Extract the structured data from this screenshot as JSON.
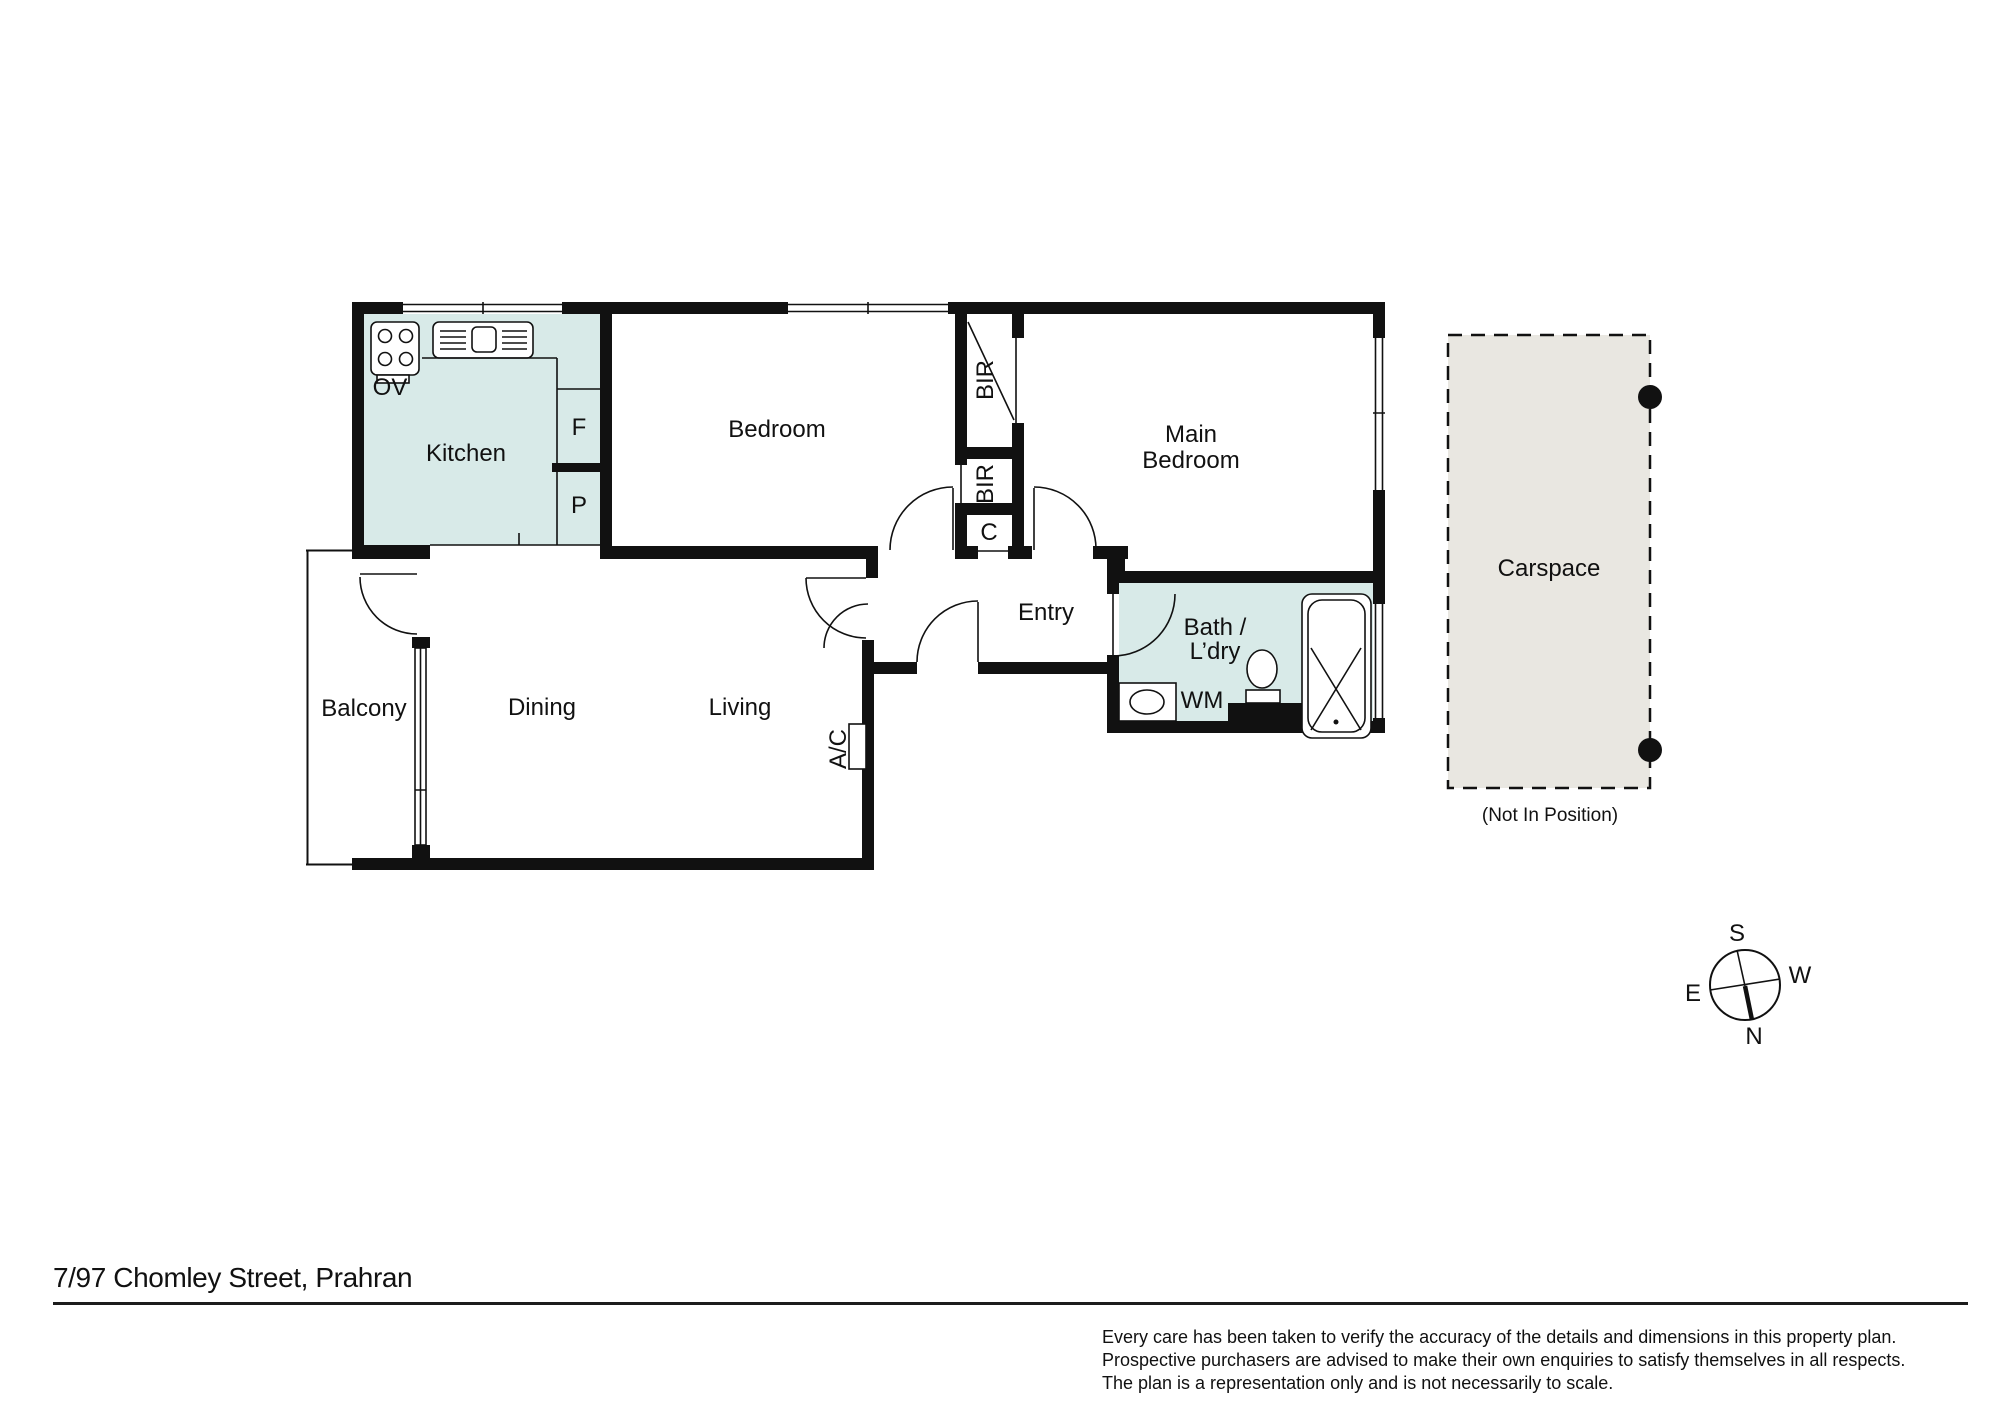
{
  "floorplan": {
    "rooms": {
      "kitchen": "Kitchen",
      "bedroom": "Bedroom",
      "main_bedroom_line1": "Main",
      "main_bedroom_line2": "Bedroom",
      "entry": "Entry",
      "bath_laundry_line1": "Bath /",
      "bath_laundry_line2": "L’dry",
      "balcony": "Balcony",
      "dining": "Dining",
      "living": "Living"
    },
    "fixtures": {
      "oven": "OV",
      "fridge": "F",
      "pantry": "P",
      "bir_upper": "BIR",
      "bir_lower": "BIR",
      "cupboard": "C",
      "washing_machine": "WM",
      "air_conditioner": "A/C"
    },
    "carspace": {
      "label": "Carspace",
      "note": "(Not In Position)"
    },
    "compass": {
      "north": "N",
      "south": "S",
      "east": "E",
      "west": "W"
    },
    "colors": {
      "wet_area_fill": "#d8eae8",
      "carspace_fill": "#e9e7e1",
      "wall": "#111111"
    }
  },
  "footer": {
    "address": "7/97 Chomley Street, Prahran",
    "disclaimer_line1": "Every care has been taken to verify the accuracy of the details and dimensions in this property plan.",
    "disclaimer_line2": "Prospective purchasers are advised to make their own enquiries to satisfy themselves in all respects.",
    "disclaimer_line3": "The plan is a representation only and is not necessarily to scale."
  }
}
